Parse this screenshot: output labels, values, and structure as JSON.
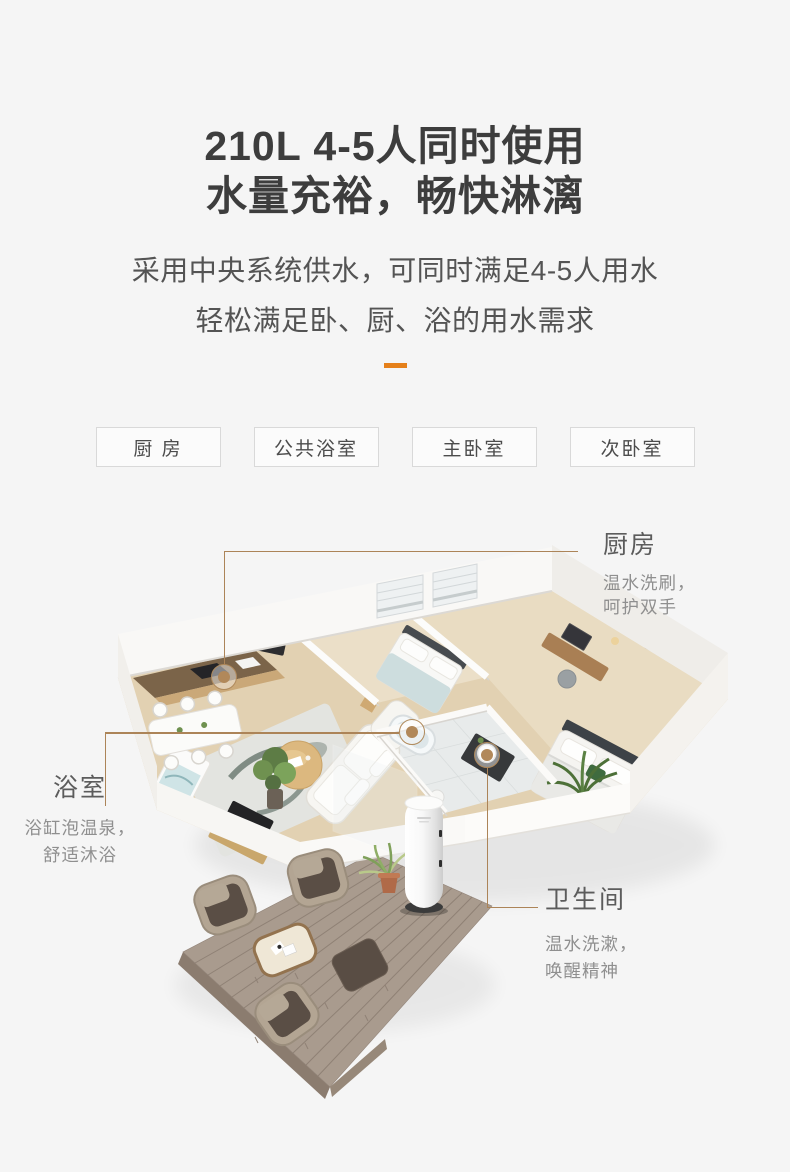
{
  "page": {
    "background": "#f5f5f5",
    "accent_color": "#e5801a",
    "connector_color": "#ac8458"
  },
  "hero": {
    "title_line1": "210L 4-5人同时使用",
    "title_line2": "水量充裕，畅快淋漓",
    "subtitle_line1": "采用中央系统供水，可同时满足4-5人用水",
    "subtitle_line2": "轻松满足卧、厨、浴的用水需求"
  },
  "room_tags": [
    {
      "label": "厨 房"
    },
    {
      "label": "公共浴室"
    },
    {
      "label": "主卧室"
    },
    {
      "label": "次卧室"
    }
  ],
  "callouts": {
    "kitchen": {
      "title": "厨房",
      "desc1": "温水洗刷，",
      "desc2": "呵护双手"
    },
    "bathroom": {
      "title": "浴室",
      "desc1": "浴缸泡温泉，",
      "desc2": "舒适沐浴"
    },
    "washroom": {
      "title": "卫生间",
      "desc1": "温水洗漱，",
      "desc2": "唤醒精神"
    }
  }
}
